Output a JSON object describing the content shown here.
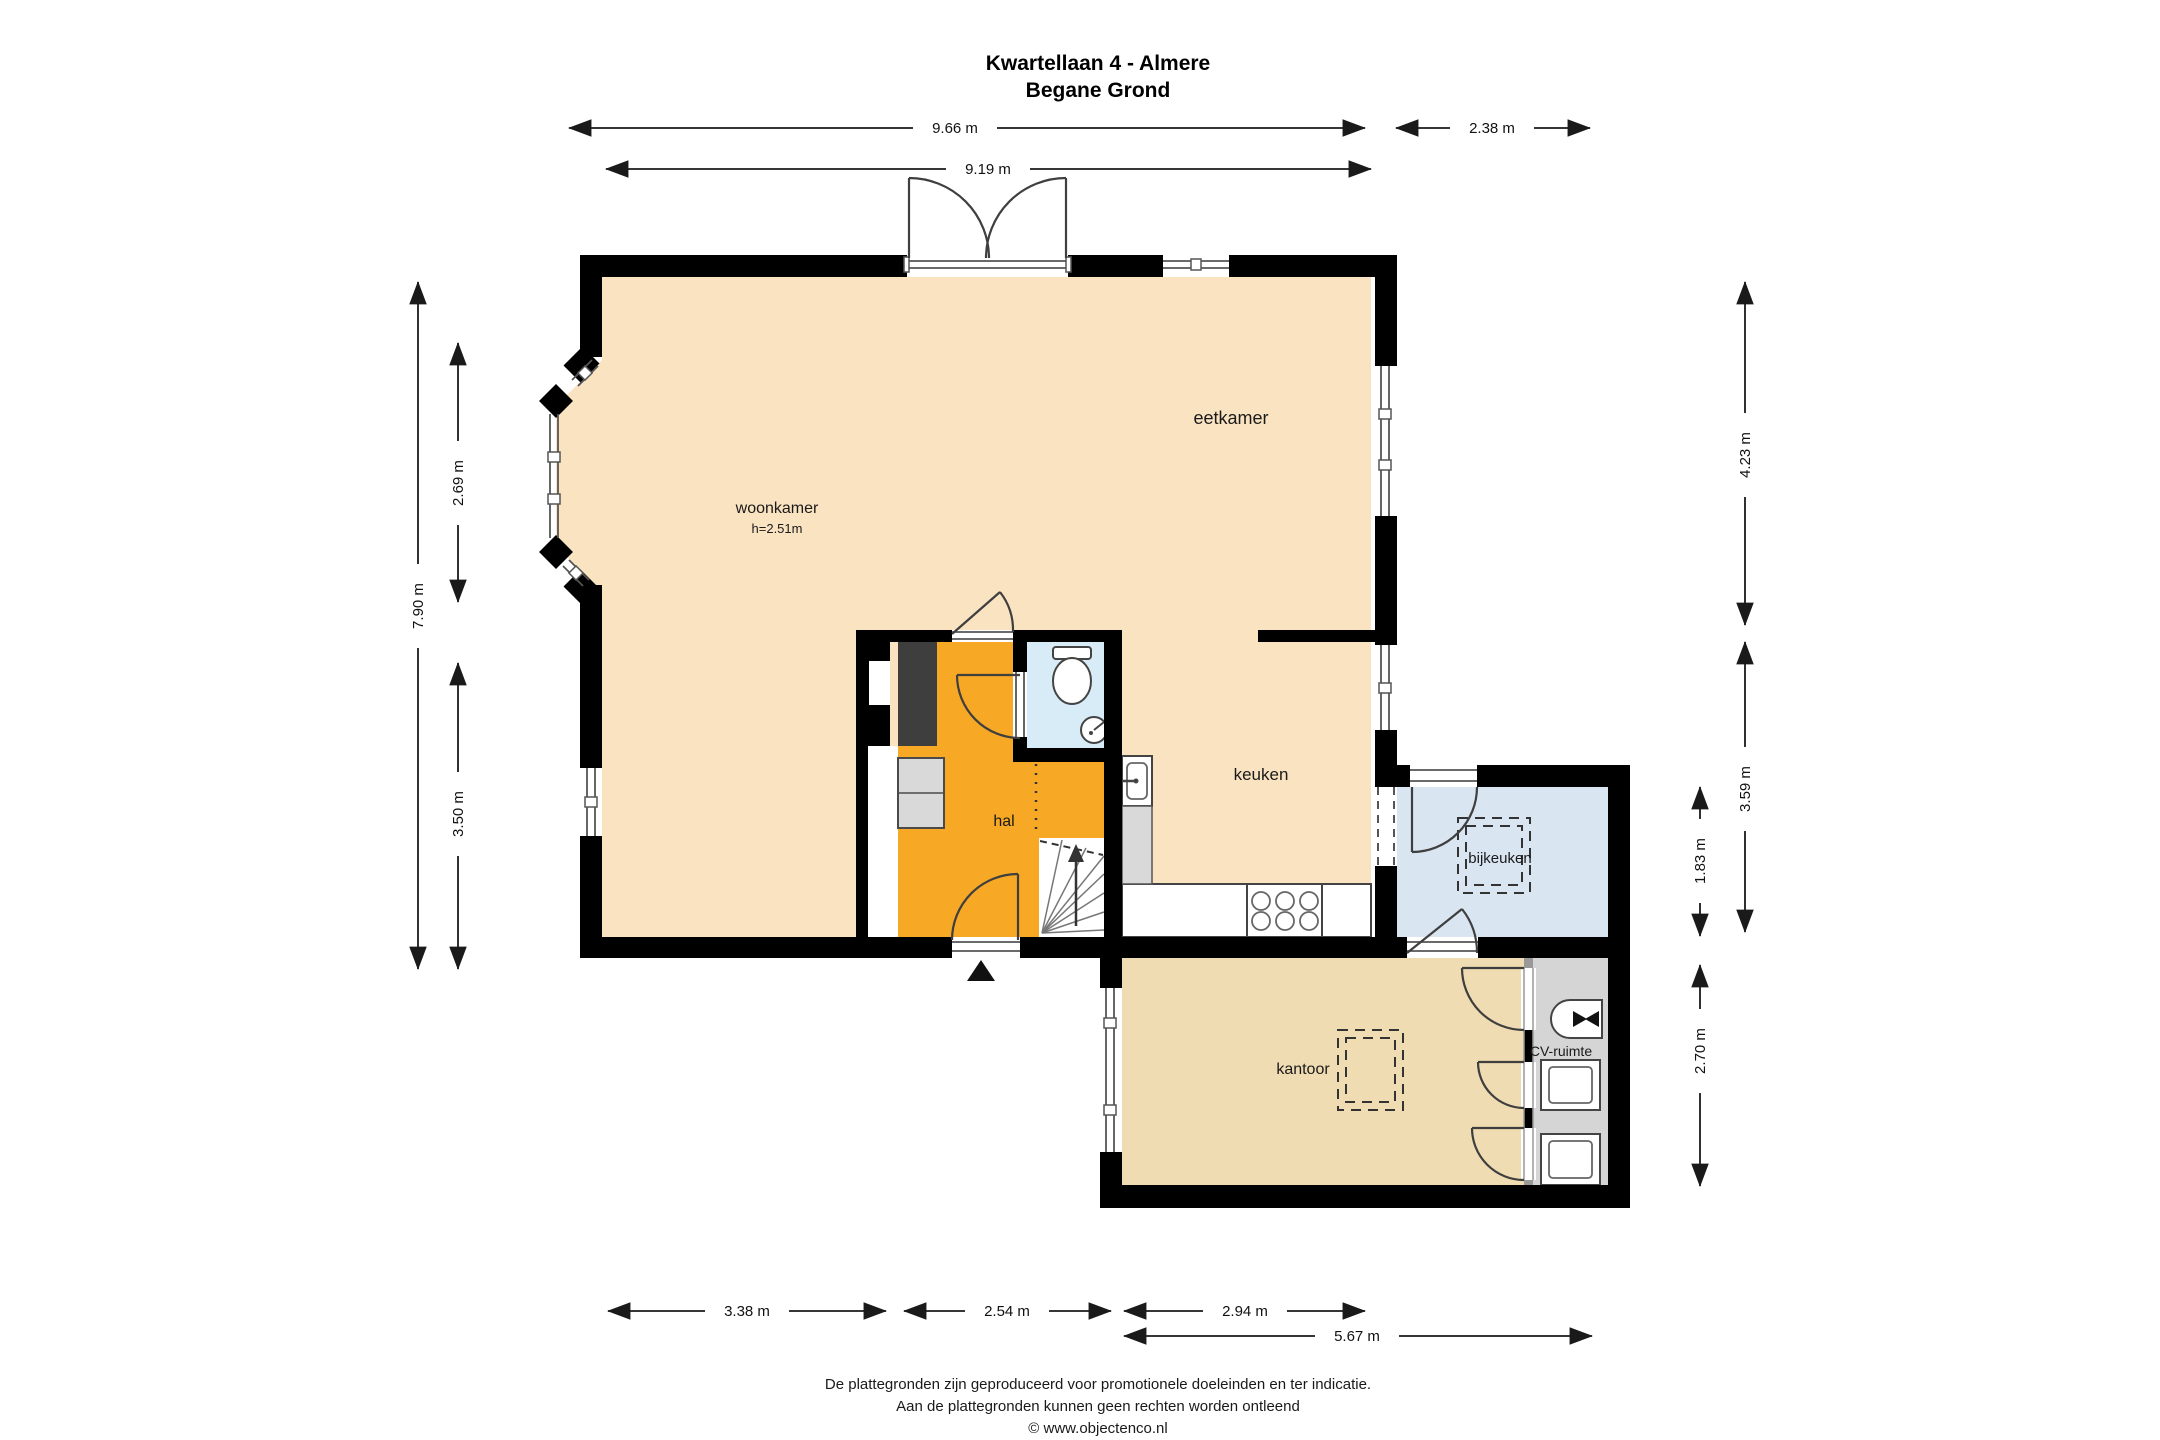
{
  "title": {
    "address": "Kwartellaan 4 - Almere",
    "floor": "Begane Grond"
  },
  "rooms": {
    "woonkamer": {
      "label": "woonkamer",
      "height_note": "h=2.51m"
    },
    "eetkamer": {
      "label": "eetkamer"
    },
    "keuken": {
      "label": "keuken"
    },
    "hal": {
      "label": "hal"
    },
    "bijkeuken": {
      "label": "bijkeuken"
    },
    "kantoor": {
      "label": "kantoor"
    },
    "cv_ruimte": {
      "label": "CV-ruimte"
    }
  },
  "dimensions": {
    "top_main": "9.66 m",
    "top_annex": "2.38 m",
    "top_inner": "9.19 m",
    "left_total": "7.90 m",
    "left_upper": "2.69 m",
    "left_lower": "3.50 m",
    "right_upper": "4.23 m",
    "right_middle": "3.59 m",
    "right_bijkeuken": "1.83 m",
    "right_kantoor": "2.70 m",
    "bottom_woonkamer": "3.38 m",
    "bottom_hal": "2.54 m",
    "bottom_keuken": "2.94 m",
    "bottom_annex": "5.67 m"
  },
  "footer": {
    "line1": "De plattegronden zijn geproduceerd voor promotionele doeleinden en ter indicatie.",
    "line2": "Aan de plattegronden kunnen geen rechten worden ontleend",
    "line3": "© www.objectenco.nl"
  },
  "colors": {
    "wall": "#000000",
    "living_area": "#FAE3C1",
    "hall": "#F7A825",
    "toilet": "#D8ECF7",
    "bijkeuken": "#DAE5F2",
    "kantoor": "#F0DCB2",
    "cv_ruimte": "#D5D5D5",
    "flue": "#3E3E3E",
    "cabinet": "#D9D9D9"
  }
}
